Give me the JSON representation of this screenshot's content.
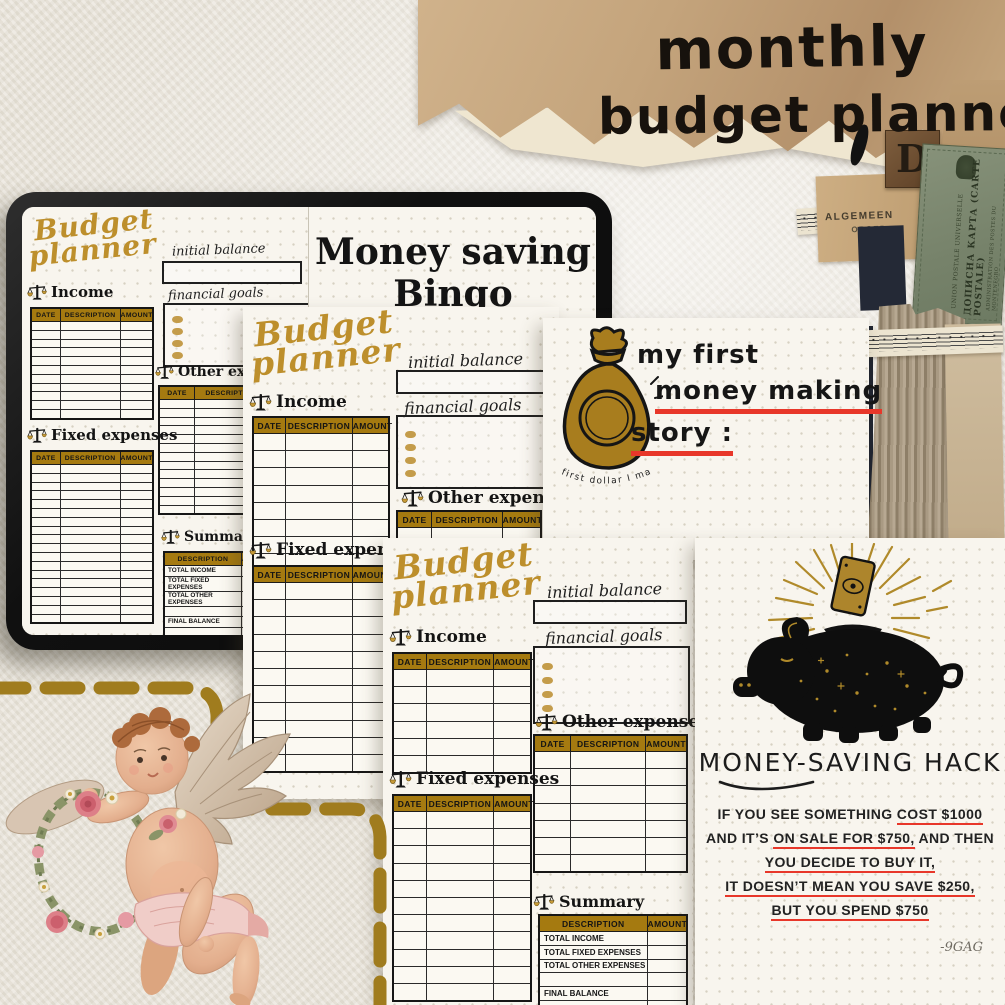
{
  "header": {
    "title_line1": "monthly",
    "title_line2": "budget planner"
  },
  "planner": {
    "title_line1": "Budget",
    "title_line2": "planner",
    "initial_balance_label": "initial balance",
    "financial_goals_label": "financial goals",
    "income_label": "Income",
    "fixed_expenses_label": "Fixed expenses",
    "other_expenses_label": "Other expenses",
    "summary_label": "Summary",
    "table_headers": {
      "date": "DATE",
      "description": "DESCRIPTION",
      "amount": "AMOUNT"
    },
    "summary_rows": [
      "TOTAL INCOME",
      "TOTAL FIXED EXPENSES",
      "TOTAL OTHER EXPENSES",
      "",
      "FINAL BALANCE",
      ""
    ]
  },
  "bingo": {
    "title_line1": "Money saving",
    "title_line2": "Bingo"
  },
  "story": {
    "line1": "my first",
    "line2": "money making",
    "line3": "story :",
    "bag_caption": "first dollar I make"
  },
  "hack": {
    "title": "MONEY-SAVING HACK",
    "lines": [
      [
        {
          "t": "IF YOU SEE SOMETHING "
        },
        {
          "t": "COST $1000",
          "u": true
        }
      ],
      [
        {
          "t": "AND IT’S "
        },
        {
          "t": "ON SALE FOR $750,",
          "u": true
        },
        {
          "t": " AND THEN"
        }
      ],
      [
        {
          "t": "YOU DECIDE TO BUY IT,",
          "u": true
        }
      ],
      [
        {
          "t": "IT DOESN’T MEAN YOU SAVE $250,",
          "u": true
        }
      ],
      [
        {
          "t": "BUT YOU SPEND $750",
          "u": true
        }
      ]
    ],
    "signature": "-9GAG"
  },
  "ephemera": {
    "block_letter": "D",
    "scrap_line1": "ALGEMEEN",
    "scrap_line2": "ORGED",
    "postcard_title": "ДОПИСНА КАРТА (CARTE POSTALE)",
    "postcard_top": "UNION POSTALE UNIVERSELLE",
    "postcard_bottom": "ADMINISTRATION DES POSTES DU MONTENEGRO"
  },
  "colors": {
    "accent_gold_bar": "#a57a10",
    "script_gold": "#bd8f2c",
    "underline_red": "#e8372a",
    "dash_gold": "#a07c1e",
    "page_background": "#f8f5ee",
    "kraft_paper": "#c4a47c",
    "tablet_black": "#101010"
  }
}
